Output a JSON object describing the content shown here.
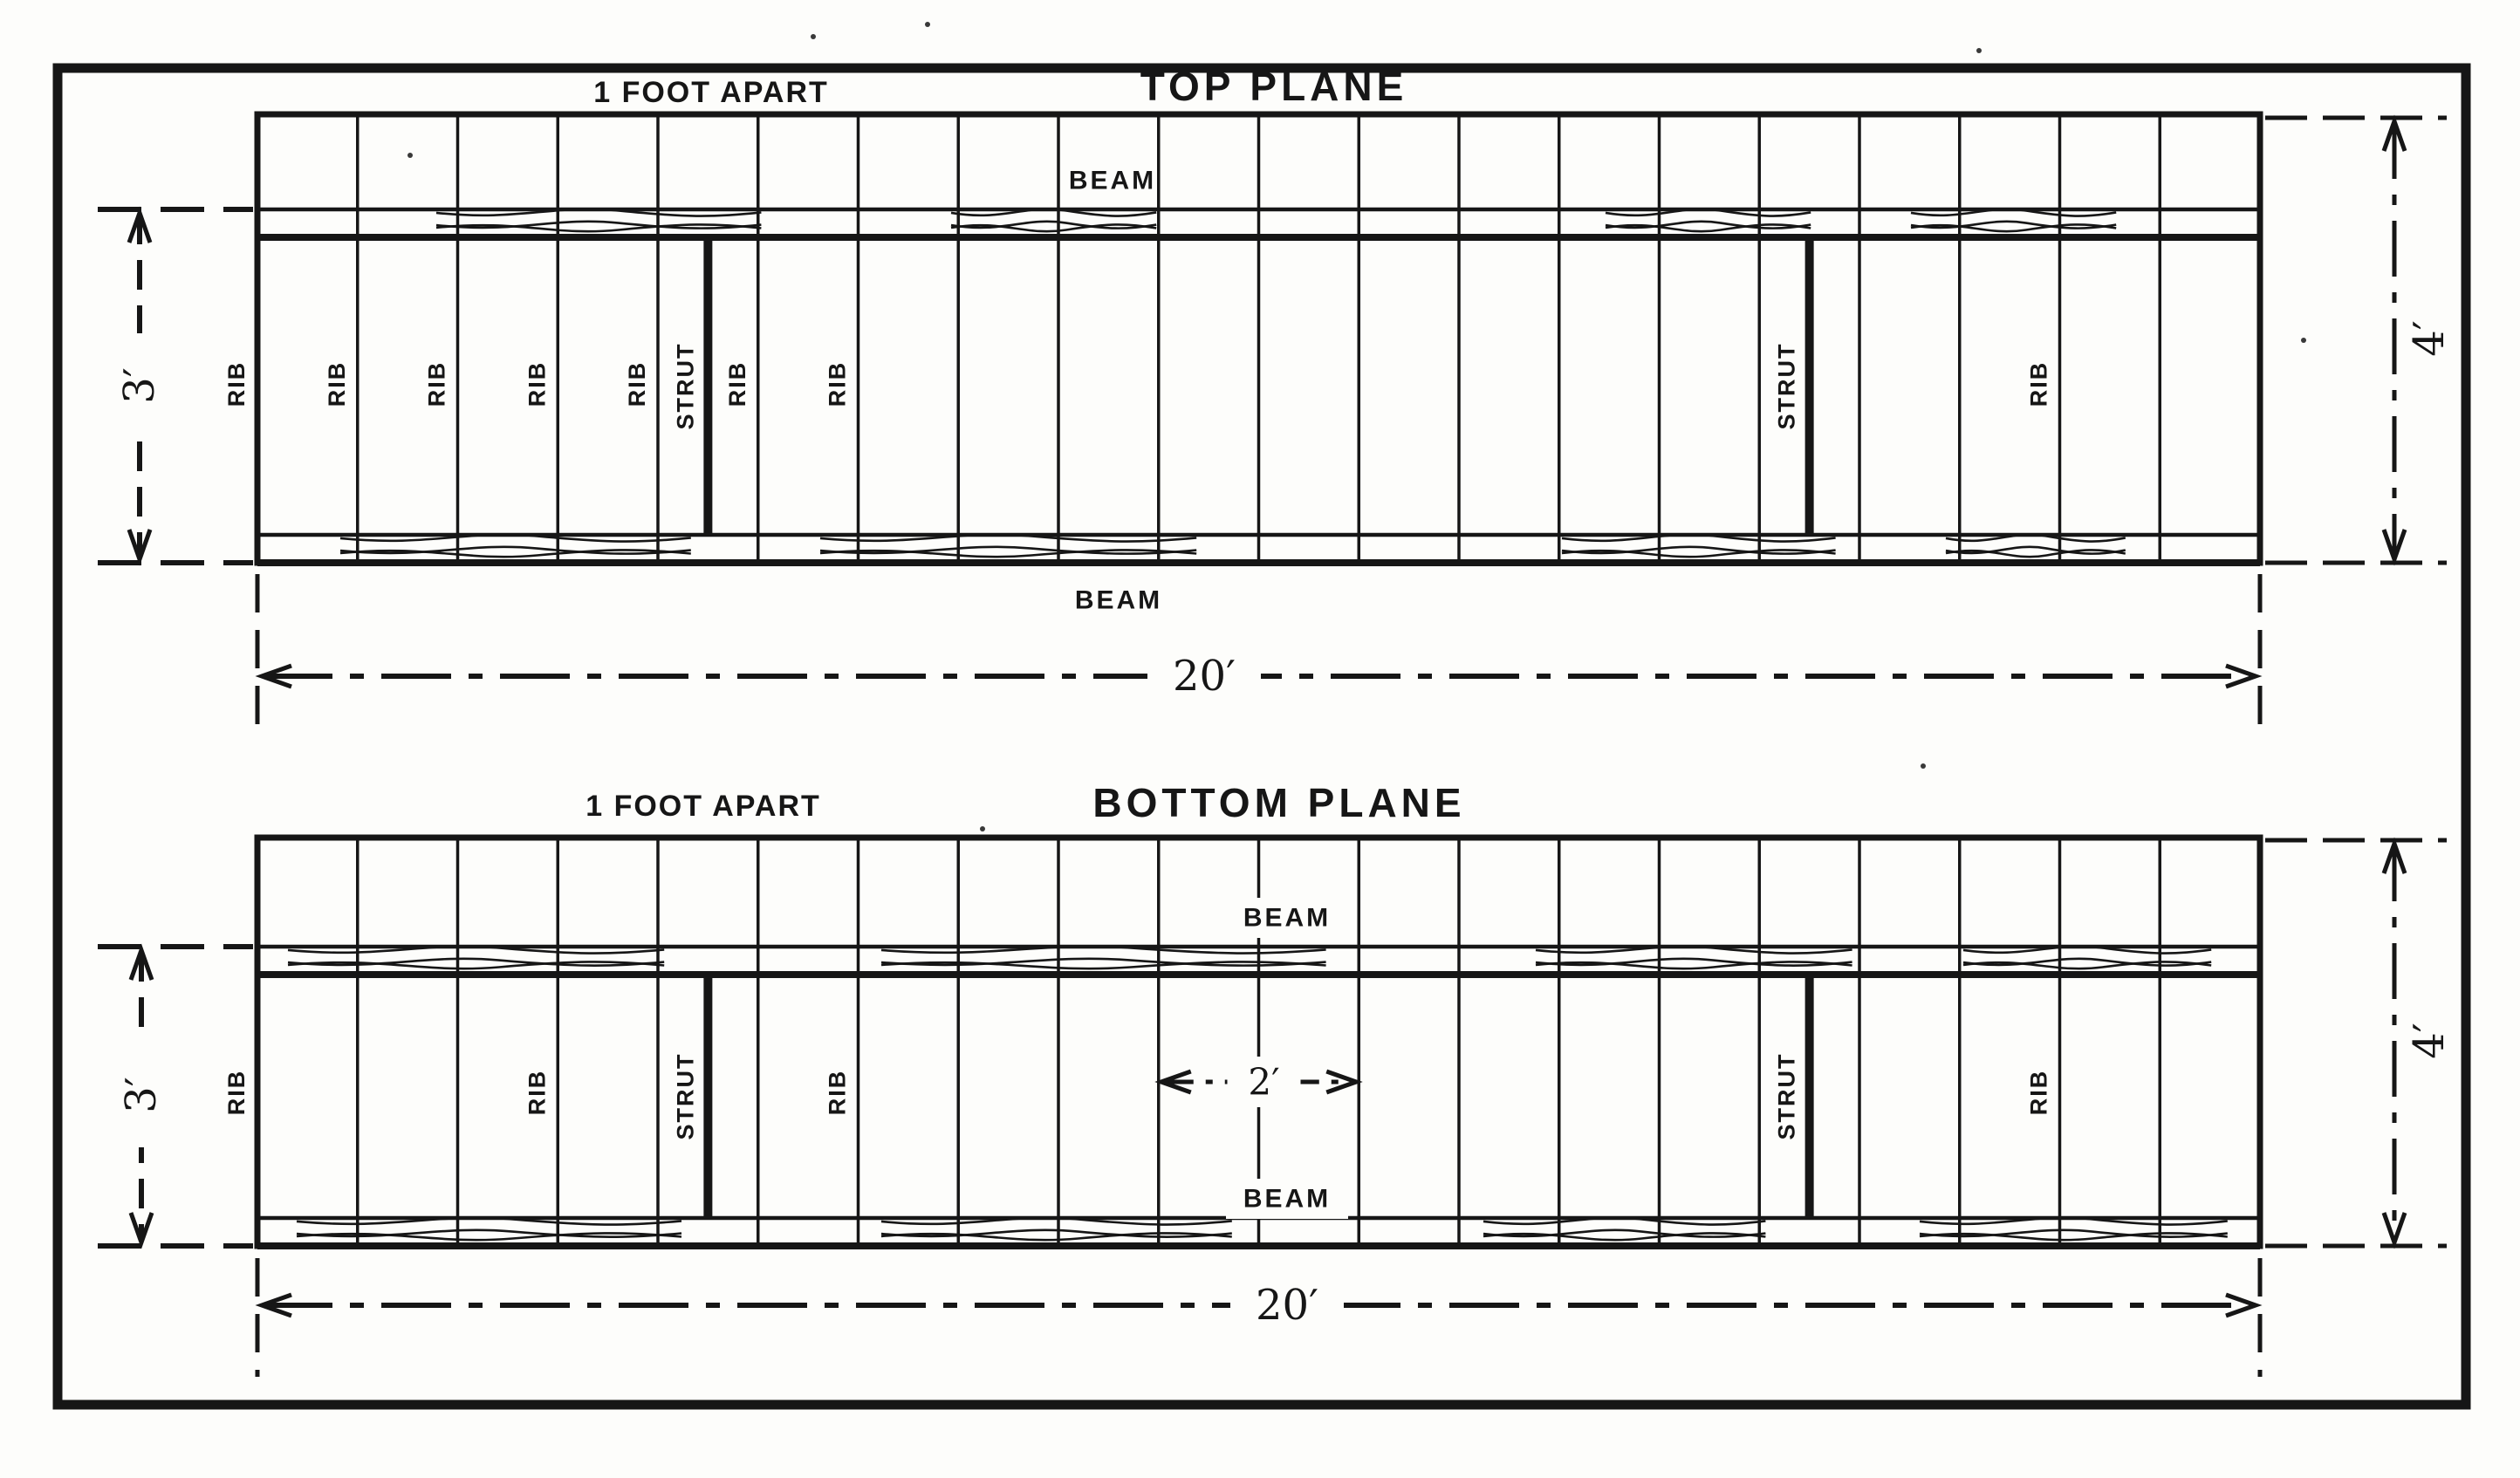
{
  "page": {
    "background": "#fdfdfb",
    "ink": "#161616"
  },
  "figure": {
    "type": "engineering-diagram",
    "subject": "Biplane wing framing plan, top and bottom planes",
    "panels": [
      {
        "title": "TOP PLANE",
        "spacing_label": "1 FOOT APART",
        "beam_label_front": "BEAM",
        "beam_label_rear": "BEAM",
        "rib_label": "RIB",
        "strut_label": "STRUT",
        "dim_beam_gap": "3′",
        "dim_span": "20′",
        "dim_chord": "4′",
        "rib_count": 21,
        "rib_spacing_feet": 1,
        "span_feet": 20,
        "chord_feet": 4,
        "beam_gap_feet": 3,
        "labeled_rib_indices": [
          0,
          1,
          2,
          3,
          4,
          5,
          6,
          18
        ],
        "strut_positions_feet": [
          4.5,
          15.5
        ]
      },
      {
        "title": "BOTTOM PLANE",
        "spacing_label": "1 FOOT APART",
        "beam_label_front": "BEAM",
        "beam_label_rear": "BEAM",
        "rib_label": "RIB",
        "strut_label": "STRUT",
        "dim_beam_gap": "3′",
        "dim_span": "20′",
        "dim_chord": "4′",
        "dim_rib_pair": "2′",
        "rib_count": 21,
        "rib_spacing_feet": 1,
        "span_feet": 20,
        "chord_feet": 4,
        "beam_gap_feet": 3,
        "labeled_rib_indices": [
          0,
          3,
          6,
          18
        ],
        "strut_positions_feet": [
          4.5,
          15.5
        ],
        "rib_pair_dim": {
          "from_rib": 9,
          "to_rib": 11,
          "feet": 2
        }
      }
    ]
  }
}
